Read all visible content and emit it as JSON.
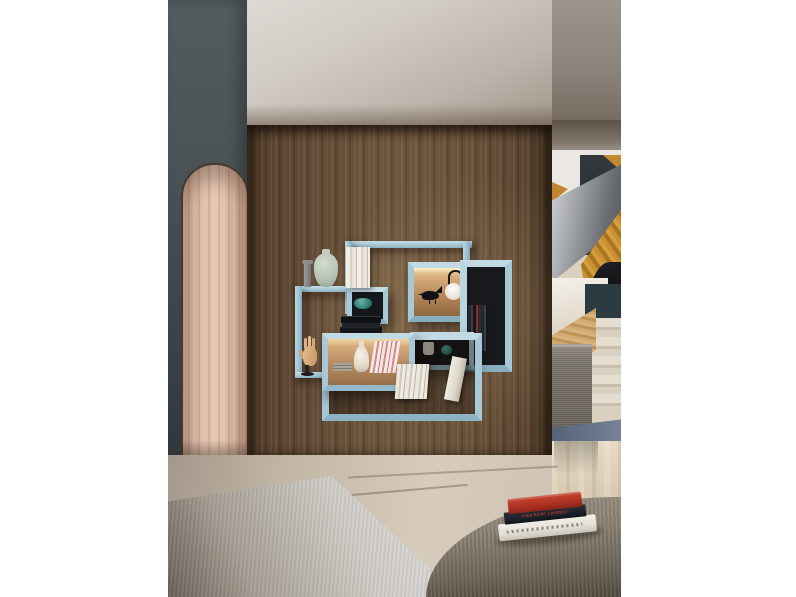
{
  "scene": {
    "type": "interior-photograph",
    "description": "Modern living room: light-blue modular wall shelving on a walnut panel wall, arched wood niche on a dark gray wall, staircase hallway at right, travertine floor with gray rug and a fabric ottoman holding a stack of books."
  },
  "palette": {
    "background_margin": "#ffffff",
    "gray_wall": "#454d50",
    "arch_wood": "#ddbba7",
    "walnut_wall": "#68523c",
    "ceiling": "#cfc9c3",
    "shelf_blue": "#a7c9d7",
    "led_glow": "#f3d9a8",
    "niche_dark": "#17191c",
    "teal_decor": "#2e7d72",
    "amber_stair_wood": "#c58a2f",
    "steel_gray": "#6a6d71",
    "bench_gray": "#7b756c",
    "mat_blue": "#5c6b80",
    "floor_stone": "#c6baa9",
    "rug_gray": "#d4d2cf",
    "ottoman_taupe": "#8b8174",
    "book_red": "#b03226",
    "book_navy": "#1b1f26",
    "book_white": "#e9e6df"
  },
  "shelving": {
    "color_name": "light blue",
    "compartments": 7,
    "lit_compartments": 2,
    "decor_items": [
      "gray candlestick",
      "celadon vase",
      "white books",
      "teal bowl",
      "black bird figurine",
      "white globe lamp",
      "dark book row",
      "white cup",
      "teal sphere",
      "black book stack",
      "wooden mannequin hand",
      "stacked plates",
      "white bottle vase",
      "pink-spine magazines",
      "standing books",
      "leaning book"
    ]
  },
  "ottoman_books": {
    "top": "red hardcover",
    "middle": "navy hardcover",
    "middle_spine_text": "YVES SAINT LAURENT",
    "bottom": "white hardcover"
  }
}
